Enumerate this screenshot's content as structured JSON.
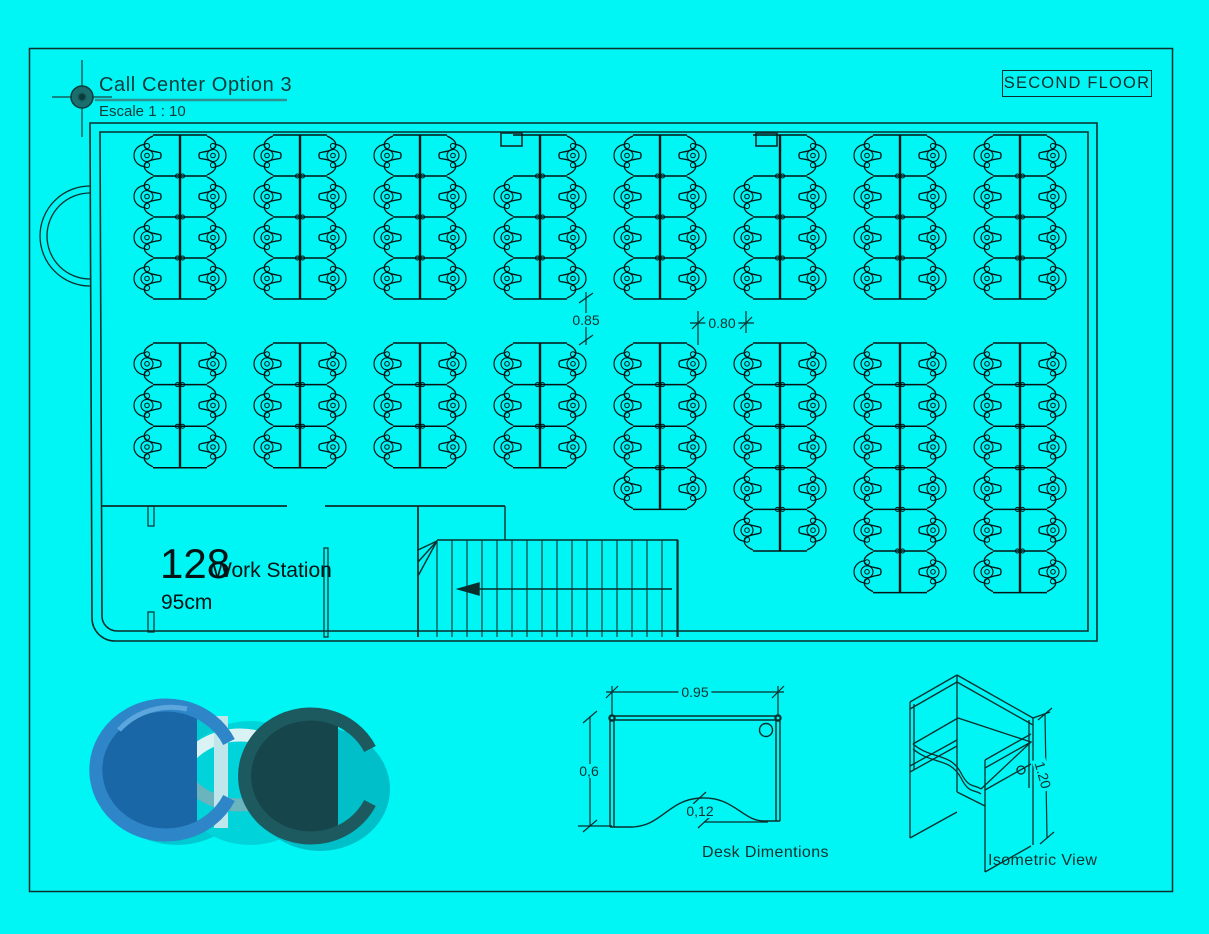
{
  "page_colors": {
    "background": "#00f5f5",
    "line_ink": "#0b2f2d",
    "title_underline_teal": "#2f9191"
  },
  "title_block": {
    "title": "Call Center Option 3",
    "scale_note": "Escale 1 : 10"
  },
  "floor_label": "SECOND FLOOR",
  "room": {
    "count": "128",
    "label": "Work Station",
    "desk_size": "95cm"
  },
  "dimensions": {
    "cluster_gap": "0.85",
    "aisle_width": "0.80",
    "desk_top_width": "0.95",
    "desk_depth": "0,6",
    "curve_depth": "0,12",
    "partition_height": "1.20"
  },
  "captions": {
    "desk_diagram": "Desk Dimentions",
    "isometric": "Isometric View"
  },
  "logo": {
    "text": "CDC",
    "blue": "#1a67a8",
    "blue_ring": "#2e85c8",
    "pale": "#d9f3f5",
    "pale_ring": "#6ab4bd",
    "dark": "#16464c",
    "dark_ring": "#1d5a60",
    "shadow": "#00c9d2"
  },
  "floor_plan": {
    "total_stations": 128,
    "spines": [
      180,
      300,
      420,
      540,
      660,
      780,
      900,
      1020
    ],
    "top": {
      "y": 135,
      "pair_h": 41,
      "pairs": 4,
      "missing_first_left": [
        3,
        5
      ]
    },
    "bottom": {
      "y": 343,
      "pair_h": 41.6,
      "pairs": [
        3,
        3,
        3,
        3,
        4,
        5,
        6,
        6
      ]
    },
    "stairs": {
      "tread_x0": 437,
      "tread_x1": 678,
      "tread_step": 15,
      "tread_y0": 540,
      "tread_y1": 637
    }
  }
}
